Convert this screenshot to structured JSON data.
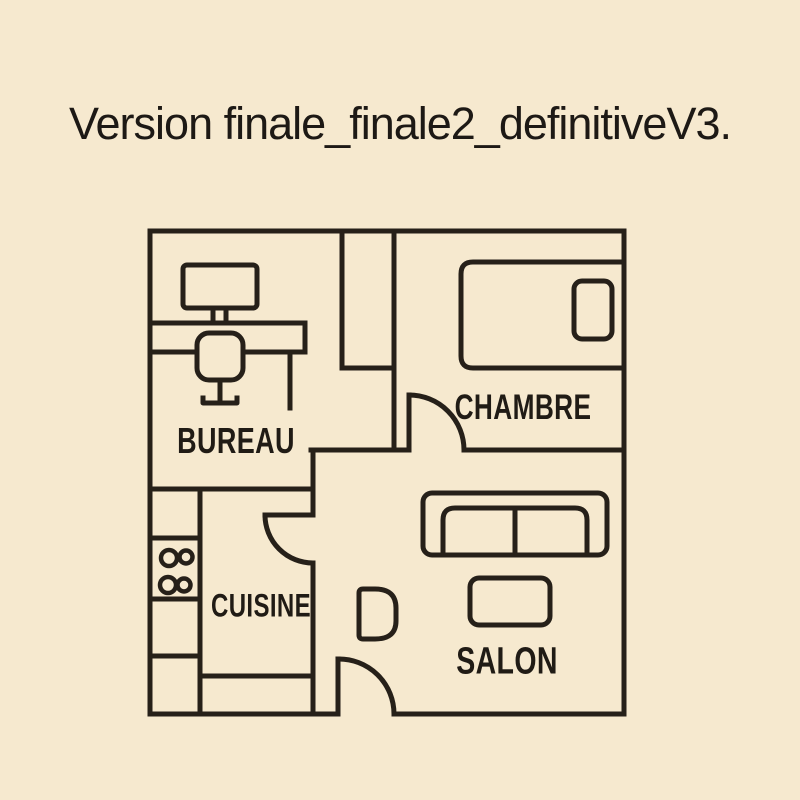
{
  "title": {
    "text": "Version finale_finale2_definitiveV3."
  },
  "floor_plan": {
    "rooms": [
      {
        "id": "bureau",
        "label": "BUREAU"
      },
      {
        "id": "chambre",
        "label": "CHAMBRE"
      },
      {
        "id": "cuisine",
        "label": "CUISINE"
      },
      {
        "id": "salon",
        "label": "SALON"
      }
    ],
    "furniture": [
      "desk-with-monitor-icon",
      "office-chair-icon",
      "bed-with-pillow-icon",
      "kitchen-counter-icon",
      "stove-burners-icon",
      "sofa-icon",
      "coffee-table-icon",
      "armchair-icon"
    ],
    "doors": [
      "chambre-door",
      "cuisine-door",
      "entrance-door"
    ],
    "stove_burner_count": 4,
    "colors": {
      "background": "#f6e9cf",
      "line": "#262019",
      "text": "#201b15"
    }
  }
}
